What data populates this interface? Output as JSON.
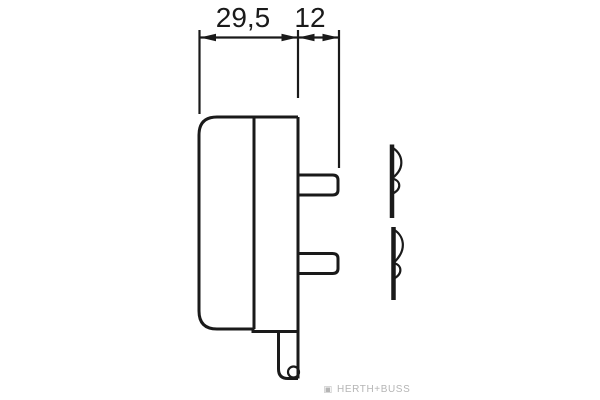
{
  "colors": {
    "bg": "#ffffff",
    "line": "#1a1a1a",
    "watermark": "#b5b5b5"
  },
  "dimensions": {
    "total_width": "29,5",
    "pin_depth": "12"
  },
  "watermark": {
    "logo": "▣",
    "text": "HERTH+BUSS"
  }
}
